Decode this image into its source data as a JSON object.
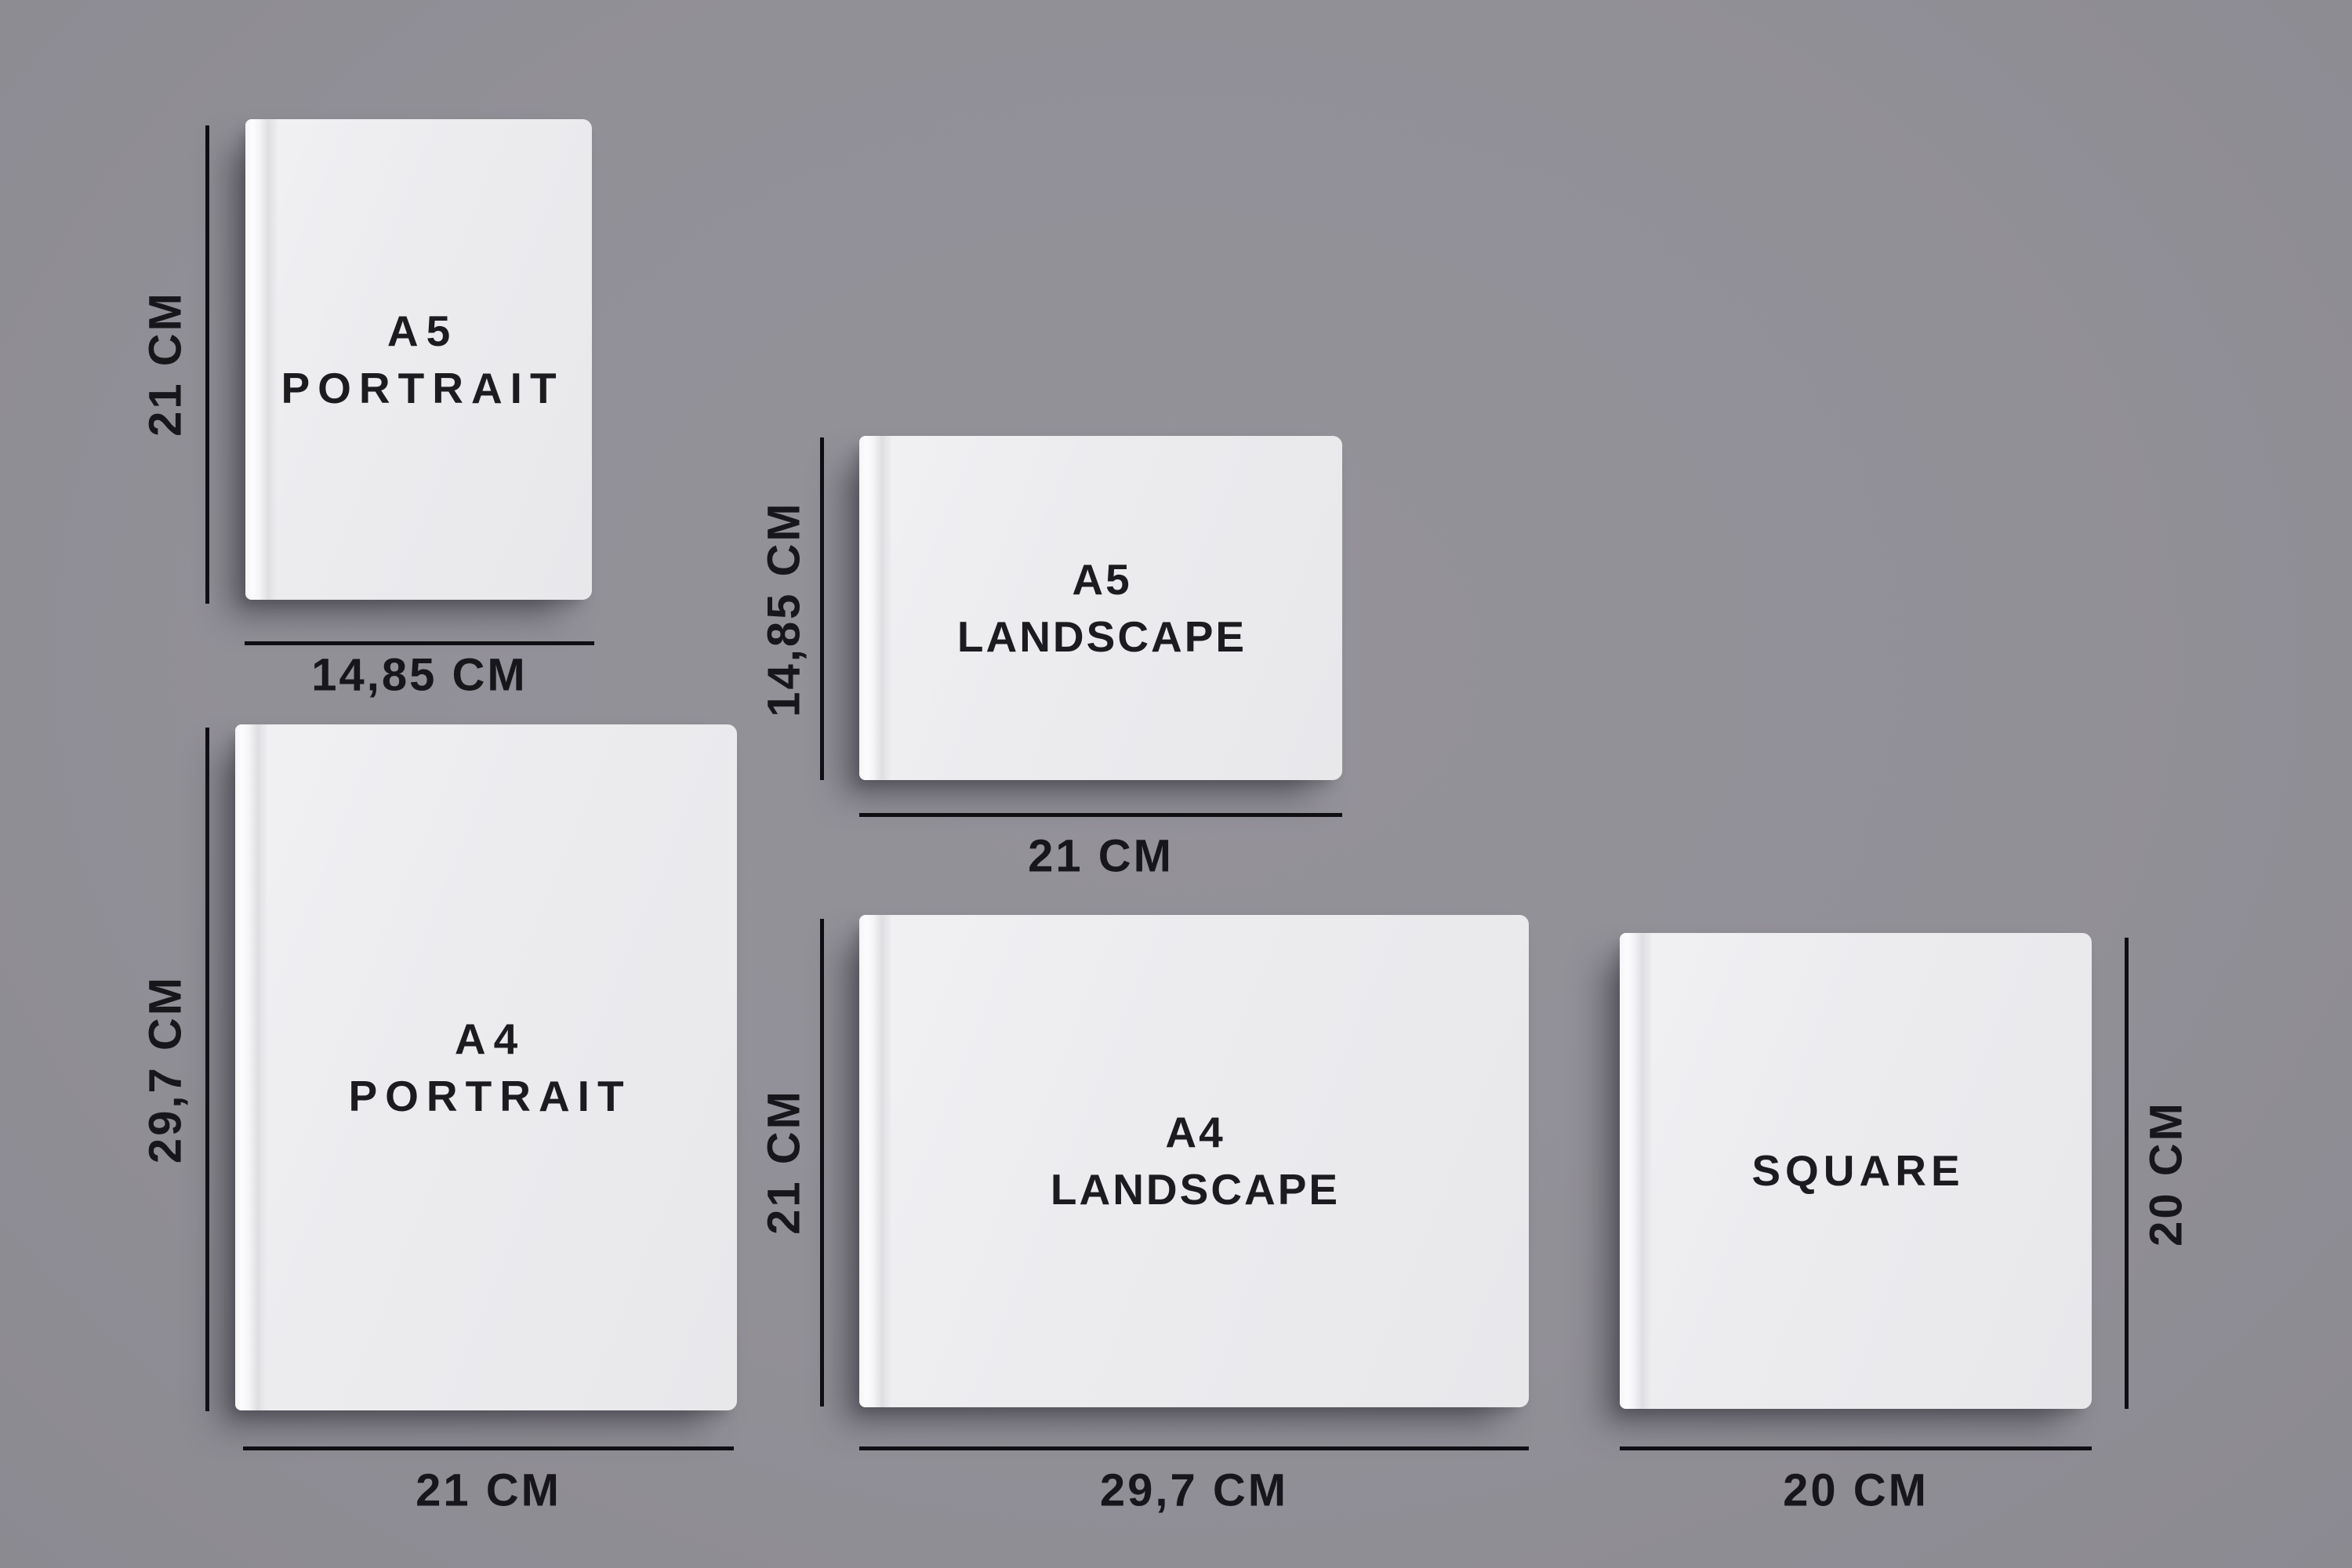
{
  "colors": {
    "background": "#929097",
    "line": "#0f0e13",
    "label": "#17161b",
    "title": "#1c1b20",
    "cover": "#ebebee"
  },
  "books": [
    {
      "name": "A5 Portrait",
      "title_line1": "A5",
      "title_line2": "PORTRAIT",
      "height_label": "21 CM",
      "width_label": "14,85 CM"
    },
    {
      "name": "A5 Landscape",
      "title_line1": "A5",
      "title_line2": "LANDSCAPE",
      "height_label": "14,85 CM",
      "width_label": "21 CM"
    },
    {
      "name": "A4 Portrait",
      "title_line1": "A4",
      "title_line2": "PORTRAIT",
      "height_label": "29,7 CM",
      "width_label": "21 CM"
    },
    {
      "name": "A4 Landscape",
      "title_line1": "A4",
      "title_line2": "LANDSCAPE",
      "height_label": "21 CM",
      "width_label": "29,7 CM"
    },
    {
      "name": "Square",
      "title_line1": "SQUARE",
      "title_line2": "",
      "height_label": "20 CM",
      "width_label": "20 CM"
    }
  ]
}
